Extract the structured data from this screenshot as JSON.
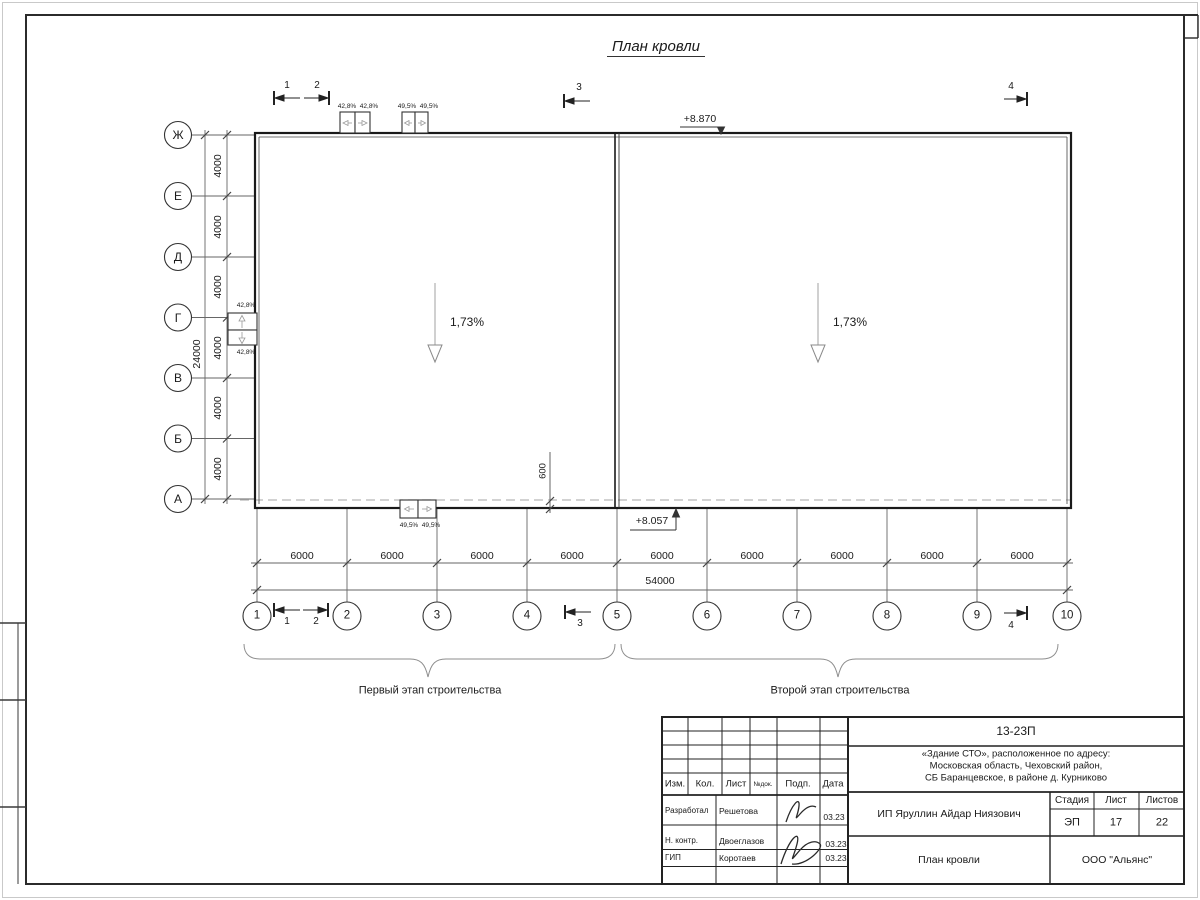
{
  "sheet": {
    "title": "План кровли"
  },
  "axes": {
    "left": [
      "Ж",
      "Е",
      "Д",
      "Г",
      "В",
      "Б",
      "А"
    ],
    "bottom": [
      "1",
      "2",
      "3",
      "4",
      "5",
      "6",
      "7",
      "8",
      "9",
      "10"
    ]
  },
  "dims": {
    "bay_v": "4000",
    "total_v": "24000",
    "bay_h": "6000",
    "total_h": "54000",
    "overhang": "600"
  },
  "elev": {
    "top": "+8.870",
    "bottom": "+8.057"
  },
  "slope": {
    "main": "1,73%",
    "p428": "42,8%",
    "p495": "49,5%"
  },
  "sections": {
    "s1": "1",
    "s2": "2",
    "s3": "3",
    "s4": "4"
  },
  "stages": {
    "first": "Первый этап строительства",
    "second": "Второй этап строительства"
  },
  "tb": {
    "code": "13-23П",
    "addr1": "«Здание СТО», расположенное по адресу:",
    "addr2": "Московская область, Чеховский район,",
    "addr3": "СБ Баранцевское, в районе д. Курниково",
    "client": "ИП Яруллин Айдар Ниязович",
    "drawing": "План кровли",
    "company": "ООО \"Альянс\"",
    "h_izm": "Изм.",
    "h_kol": "Кол.",
    "h_list": "Лист",
    "h_ndok": "№док.",
    "h_podp": "Подп.",
    "h_data": "Дата",
    "h_stage": "Стадия",
    "h_sheet": "Лист",
    "h_sheets": "Листов",
    "stage": "ЭП",
    "sheet": "17",
    "sheets": "22",
    "r1_role": "Разработал",
    "r1_name": "Решетова",
    "r1_date": "03.23",
    "r2_role": "Н. контр.",
    "r2_name": "Двоеглазов",
    "r2_date": "03.23",
    "r3_role": "ГИП",
    "r3_name": "Коротаев",
    "r3_date": "03.23"
  }
}
